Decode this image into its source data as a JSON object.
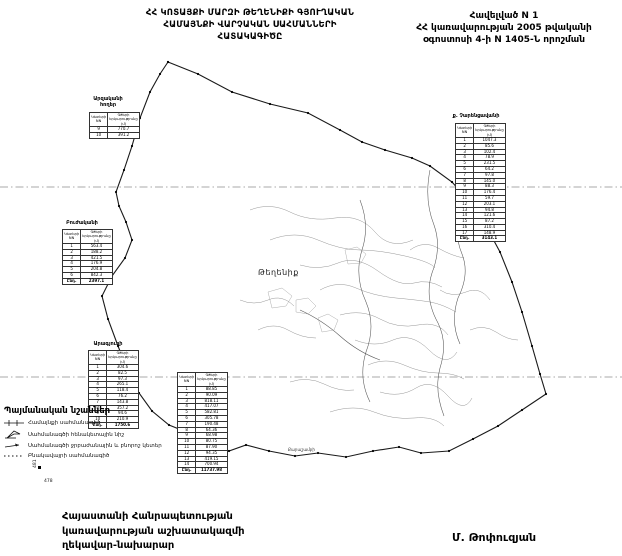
{
  "annex": {
    "line1": "Հավելված N 1",
    "line2": "ՀՀ կառավարության 2005 թվականի",
    "line3": "օգոստոսի 4-ի N 1405-Ն որոշման"
  },
  "title": {
    "line1": "ՀՀ ԿՈՏԱՅՔԻ ՄԱՐԶԻ ԹԵՂԵՆԻՔԻ ԳՅՈՒՂԱԿԱՆ",
    "line2": "ՀԱՄԱՅՆՔԻ ՎԱՐՉԱԿԱՆ  ՍԱՀՄԱՆՆԵՐԻ",
    "line3": "ՀԱՏԱԿԱԳԻԾԸ"
  },
  "map": {
    "village_label": "Թեղենիք",
    "neighbor_label": "Քարաշամբի",
    "elevation_marks": [
      "481",
      "478"
    ],
    "boundary_color": "#1a1a1a",
    "contour_color": "#8a8a8a"
  },
  "tables": [
    {
      "title": "Արզականի",
      "subtitle": "հողեր",
      "columns": [
        "Կետերի NN",
        "Գծերի երկարությունը (մ)"
      ],
      "rows": [
        [
          "9",
          "770.7"
        ],
        [
          "10",
          "391.2"
        ]
      ],
      "total": null
    },
    {
      "title": "Բուժականի",
      "subtitle": "",
      "columns": [
        "Կետերի NN",
        "Գծերի երկարությունը (մ)"
      ],
      "rows": [
        [
          "1",
          "563.4"
        ],
        [
          "2",
          "188.2"
        ],
        [
          "3",
          "421.5"
        ],
        [
          "4",
          "176.9"
        ],
        [
          "5",
          "204.8"
        ],
        [
          "6",
          "842.3"
        ]
      ],
      "total": [
        "Ընդ.",
        "2397.1"
      ]
    },
    {
      "title": "Արագյուղի",
      "subtitle": "",
      "columns": [
        "Կետերի NN",
        "Գծերի երկարությունը (մ)"
      ],
      "rows": [
        [
          "1",
          "304.6"
        ],
        [
          "2",
          "82.5"
        ],
        [
          "3",
          "97.3"
        ],
        [
          "4",
          "265.1"
        ],
        [
          "5",
          "118.4"
        ],
        [
          "6",
          "76.2"
        ],
        [
          "7",
          "143.8"
        ],
        [
          "8",
          "357.2"
        ],
        [
          "9",
          "94.6"
        ],
        [
          "10",
          "210.9"
        ]
      ],
      "total": [
        "Ընդ.",
        "1750.6"
      ]
    },
    {
      "title": "ք. Չարենցավանի",
      "subtitle": "",
      "columns": [
        "Կետերի NN",
        "Գծերի երկարությունը (մ)"
      ],
      "rows": [
        [
          "1",
          "1047.3"
        ],
        [
          "2",
          "85.6"
        ],
        [
          "3",
          "102.4"
        ],
        [
          "4",
          "78.9"
        ],
        [
          "5",
          "231.5"
        ],
        [
          "6",
          "64.2"
        ],
        [
          "7",
          "97.8"
        ],
        [
          "8",
          "145.0"
        ],
        [
          "9",
          "88.3"
        ],
        [
          "10",
          "176.4"
        ],
        [
          "11",
          "59.7"
        ],
        [
          "12",
          "203.1"
        ],
        [
          "13",
          "94.8"
        ],
        [
          "14",
          "121.6"
        ],
        [
          "15",
          "87.2"
        ],
        [
          "16",
          "310.4"
        ],
        [
          "17",
          "148.9"
        ]
      ],
      "total": [
        "Ընդ.",
        "3143.1"
      ]
    },
    {
      "title": "",
      "subtitle": "",
      "columns": [
        "Կետերի NN",
        "Գծերի երկարությունը (մ)"
      ],
      "rows": [
        [
          "1",
          "88.85"
        ],
        [
          "2",
          "90.09"
        ],
        [
          "3",
          "818.11"
        ],
        [
          "4",
          "417.07"
        ],
        [
          "5",
          "582.81"
        ],
        [
          "6",
          "305.78"
        ],
        [
          "7",
          "190.48"
        ],
        [
          "8",
          "64.36"
        ],
        [
          "9",
          "68.98"
        ],
        [
          "10",
          "80.75"
        ],
        [
          "11",
          "87.90"
        ],
        [
          "12",
          "94.35"
        ],
        [
          "13",
          "419.15"
        ],
        [
          "14",
          "700.94"
        ]
      ],
      "total": [
        "Ընդ.",
        "11737.98"
      ]
    }
  ],
  "legend": {
    "title": "Պայմանական նշաններ",
    "items": [
      {
        "symbol": "community-boundary-line",
        "label": "Համայնքի սահմանագիծ"
      },
      {
        "symbol": "benchmark-flag",
        "label": "Սահմանագծի հենակետային նիշ"
      },
      {
        "symbol": "characteristic-point-arrow",
        "label": "Սահմանագծի ջրբաժանային և բնորոշ կետեր"
      },
      {
        "symbol": "settlement-boundary-dotted",
        "label": "Բնակավայրի սահմանագիծ"
      }
    ]
  },
  "footer": {
    "org_line1": "Հայաստանի Հանրապետության",
    "org_line2": "կառավարության աշխատակազմի",
    "org_line3": "ղեկավար-նախարար",
    "signature": "Մ. Թոփուզյան"
  }
}
